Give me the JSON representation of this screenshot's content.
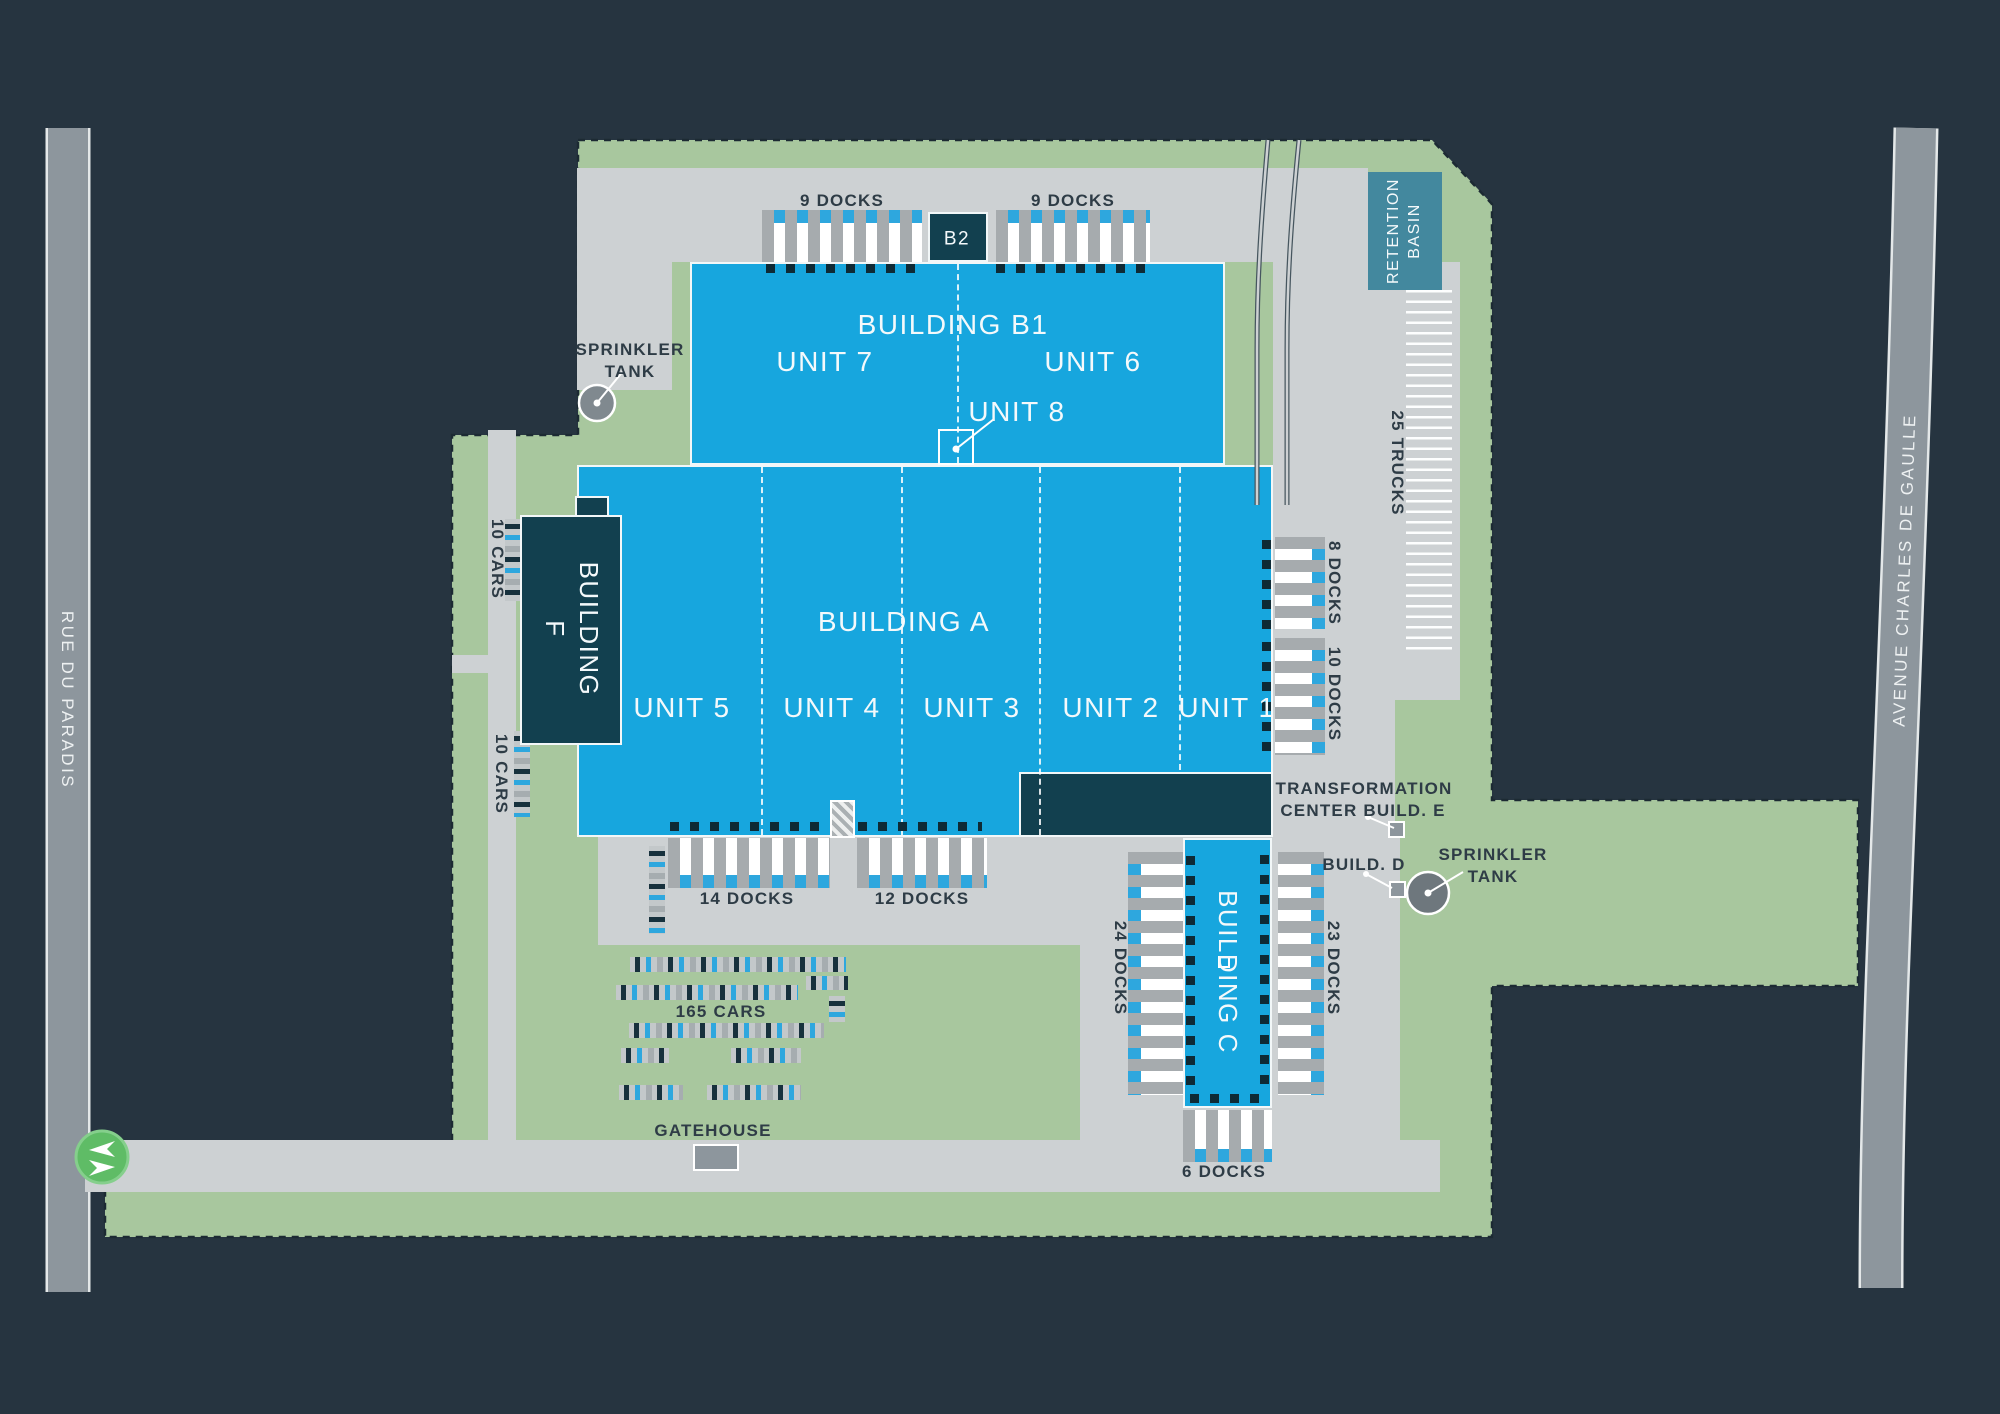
{
  "map": {
    "roads": {
      "left": "RUE DU PARADIS",
      "right": "AVENUE CHARLES DE GAULLE"
    },
    "buildings": {
      "b1": {
        "title": "BUILDING B1",
        "unit7": "UNIT 7",
        "unit6": "UNIT 6",
        "unit8": "UNIT 8"
      },
      "b2": "B2",
      "a": {
        "title": "BUILDING A",
        "unit5": "UNIT 5",
        "unit4": "UNIT 4",
        "unit3": "UNIT 3",
        "unit2": "UNIT 2",
        "unit1": "UNIT 1"
      },
      "f": "BUILDING F",
      "c": "BUILDING C"
    },
    "facilities": {
      "retention_basin": "RETENTION BASIN",
      "sprinkler_tank_west": "SPRINKLER TANK",
      "sprinkler_tank_east": "SPRINKLER TANK",
      "transformation_center": "TRANSFORMATION CENTER BUILD. E",
      "build_d": "BUILD. D",
      "gatehouse": "GATEHOUSE"
    },
    "capacities": {
      "docks_top_west": "9 DOCKS",
      "docks_top_east": "9 DOCKS",
      "docks_east_8": "8 DOCKS",
      "docks_east_10": "10 DOCKS",
      "docks_c_east": "23 DOCKS",
      "docks_c_west": "24 DOCKS",
      "docks_south_14": "14 DOCKS",
      "docks_south_12": "12 DOCKS",
      "docks_c_south": "6 DOCKS",
      "trucks": "25 TRUCKS",
      "cars_main": "165 CARS",
      "cars_f_north": "10 CARS",
      "cars_f_south": "10 CARS"
    },
    "colors": {
      "background": "#263440",
      "site_green": "#a8c79e",
      "building_blue": "#17a6de",
      "building_navy": "#12404f",
      "pavement": "#cdd1d3",
      "apron_gray": "#a6abae",
      "road_gray": "#8d969d",
      "retention_teal": "#43889e",
      "entrance_green": "#5fbc66",
      "truck_cab_blue": "#2ea7de"
    }
  }
}
